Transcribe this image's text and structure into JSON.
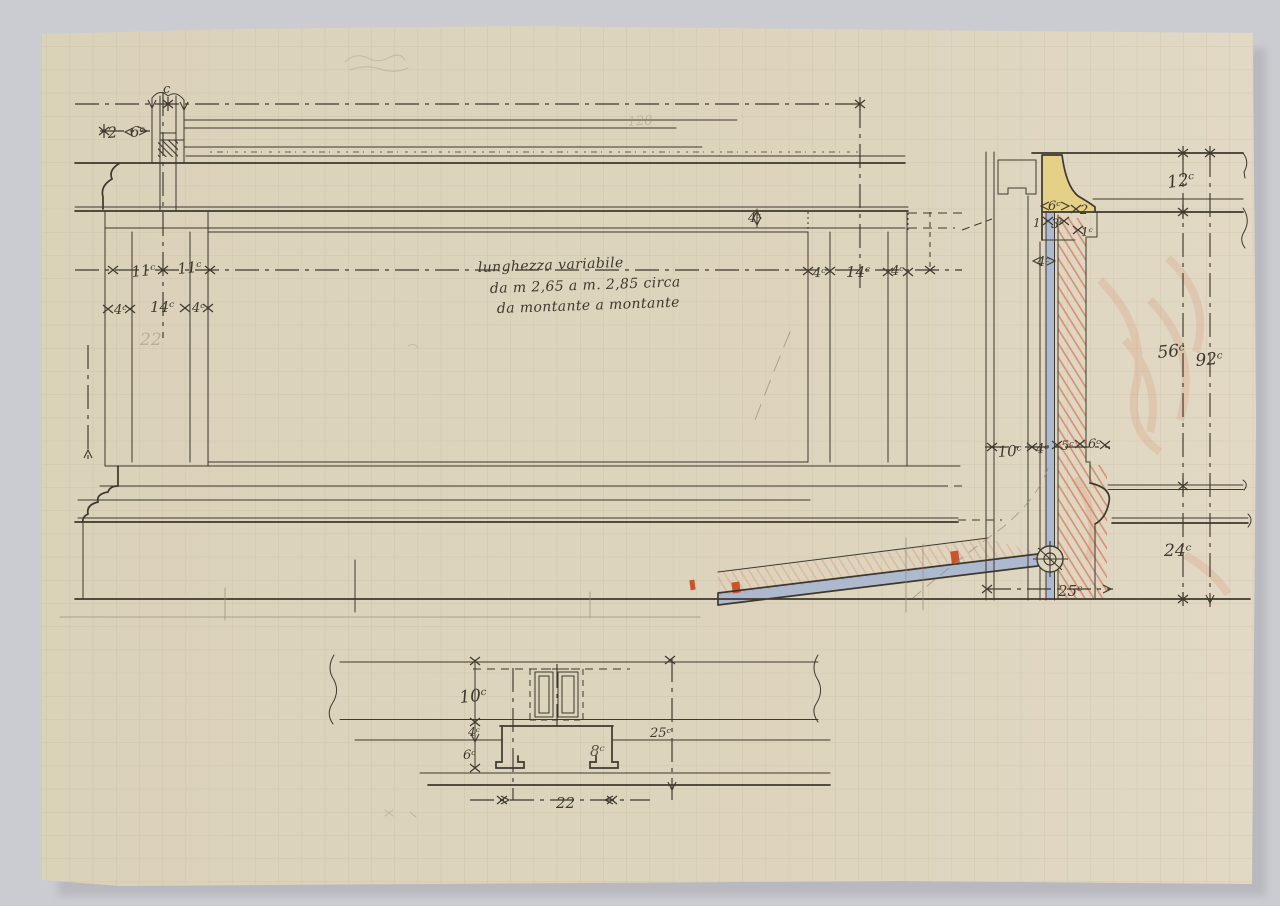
{
  "artwork": {
    "kind": "hand-drawn construction sketch of panelled bench/boiserie on squared paper",
    "language": "Italian",
    "unit_mark": "c"
  },
  "note": {
    "line1": "lunghezza variabile",
    "line2": "da m 2,65 a m. 2,85 circa",
    "line3": "da montante a montante"
  },
  "labels": {
    "top_left": {
      "c_mark": "c",
      "gap": "2",
      "post_width": "6ᶜ"
    },
    "panel_left": {
      "half_a": "11ᶜ",
      "half_b": "11ᶜ",
      "stile_a": "4ᶜ",
      "stile_mid": "14ᶜ",
      "stile_b": "4ᶜ",
      "pencil_total": "22"
    },
    "top_rail": {
      "height": "4ᶜ"
    },
    "panel_right": {
      "stile_a": "4ᶜ",
      "stile_mid": "14ᶜ",
      "stile_b": "4ᶜ"
    },
    "pencil_top": "128",
    "section": {
      "molding_w": "6ᶜ",
      "molding_step": "2",
      "edge_a": "1",
      "groove": "3ᶜ",
      "edge_b": "1ᶜ",
      "strip": "4ᶜ",
      "seat_thickness": "12ᶜ",
      "back_height": "56ᶜ",
      "total_height": "92ᶜ",
      "d10": "10ᶜ",
      "d4": "4ᶜ",
      "d5": "5ᶜ",
      "d6": "6ᶜ",
      "base_height": "24ᶜ",
      "base_depth": "25ᶜ"
    },
    "plan": {
      "depth": "10ᶜ",
      "step_a": "4ᶜ",
      "step_b": "6ᶜ",
      "inner": "8ᶜ",
      "total_depth": "25ᶜ",
      "width": "22"
    }
  },
  "colors": {
    "backdrop": "#cbccd1",
    "paper": "#ddd4be",
    "grid": "#b9ac8f",
    "ink": "#3e382d",
    "pencil": "#968c7a",
    "hatch_red": "#d4765a",
    "mark_red": "#c8552a",
    "molding_yellow": "#e4cf81",
    "member_blue": "#aab7d0"
  }
}
